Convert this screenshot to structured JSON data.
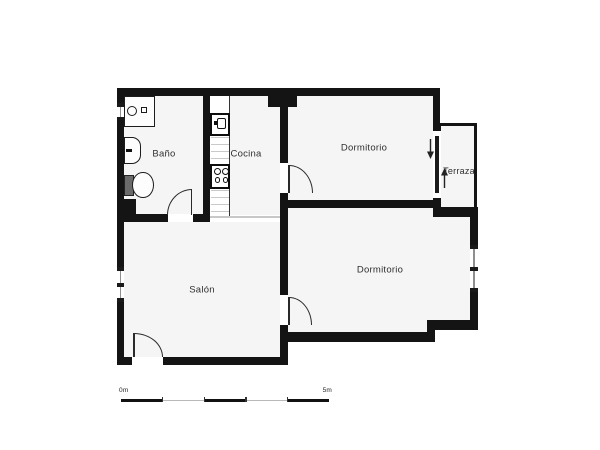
{
  "plan": {
    "rooms": [
      {
        "name": "bano",
        "label": "Baño"
      },
      {
        "name": "cocina",
        "label": "Cocina"
      },
      {
        "name": "dormitorio-top",
        "label": "Dormitorio"
      },
      {
        "name": "terraza",
        "label": "Terraza"
      },
      {
        "name": "salon",
        "label": "Salón"
      },
      {
        "name": "dormitorio-bottom",
        "label": "Dormitorio"
      }
    ],
    "scale_bar": {
      "start_label": "0m",
      "end_label": "5m"
    },
    "colors": {
      "wall": "#141414",
      "room_fill": "#f5f5f5",
      "text": "#2f2f2f",
      "window_line": "#8f8f8f",
      "passage": "#c8c8c8",
      "scale_thin": "#b9b9b9",
      "fixture_line": "#1c1c1c"
    }
  }
}
